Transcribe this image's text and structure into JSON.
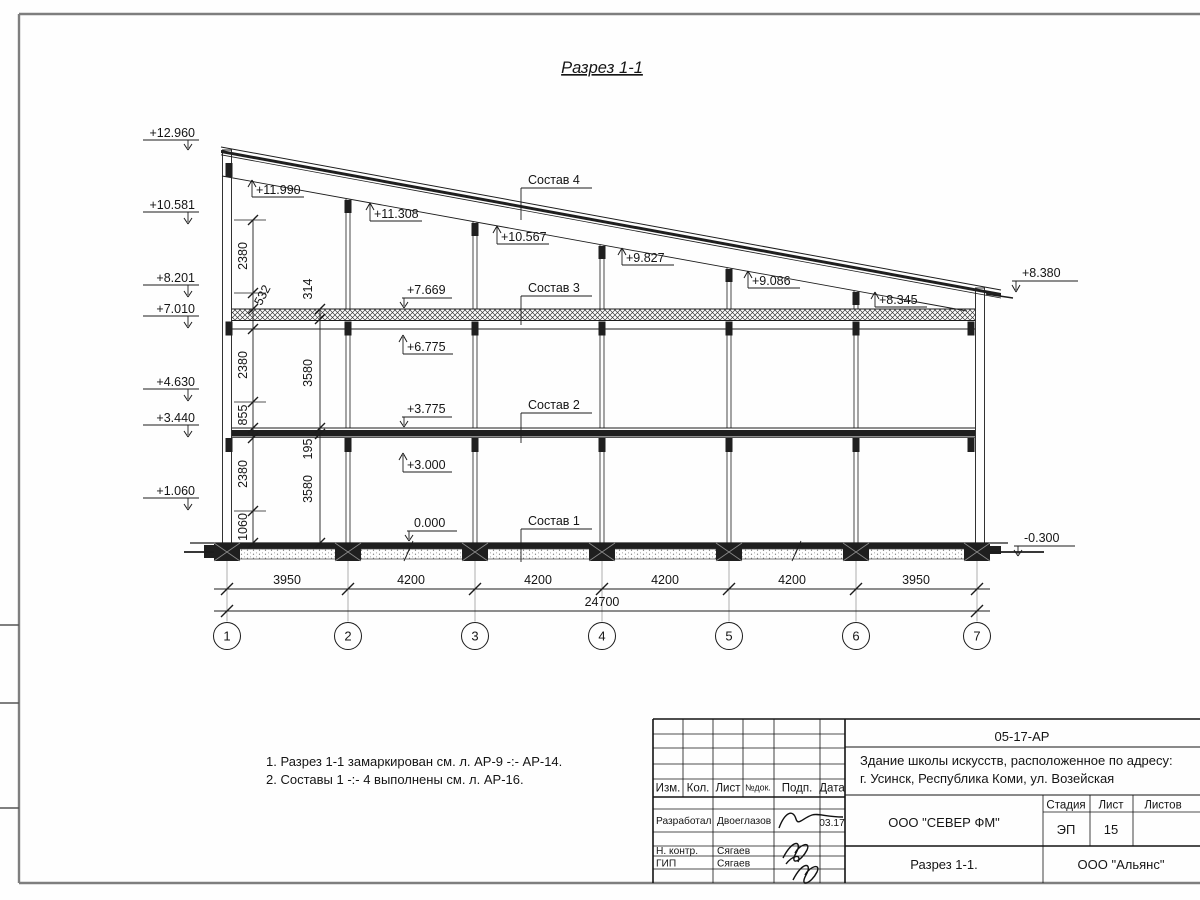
{
  "drawing_title": "Разрез 1-1",
  "section": {
    "left_marks": [
      "+12.960",
      "+10.581",
      "+8.201",
      "+7.010",
      "+4.630",
      "+3.440",
      "+1.060"
    ],
    "roof_marks": [
      "+11.990",
      "+11.308",
      "+10.567",
      "+9.827",
      "+9.086",
      "+8.345"
    ],
    "ceiling_top_mark": "+7.669",
    "ceiling_bottom_mark": "+6.775",
    "floor_top_mark": "+3.775",
    "floor_bottom_mark": "+3.000",
    "ground_mark": "0.000",
    "right_roof_mark": "+8.380",
    "right_ground_mark": "-0.300",
    "layers": [
      "Состав 4",
      "Состав 3",
      "Состав 2",
      "Состав 1"
    ],
    "vdims_a": [
      "2380",
      "532",
      "2380",
      "855",
      "2380",
      "1060"
    ],
    "vdims_b": [
      "314",
      "3580",
      "195",
      "3580"
    ],
    "hdims": [
      "3950",
      "4200",
      "4200",
      "4200",
      "4200",
      "3950"
    ],
    "total": "24700",
    "axes": [
      "1",
      "2",
      "3",
      "4",
      "5",
      "6",
      "7"
    ]
  },
  "notes": [
    "1. Разрез 1-1 замаркирован см. л. АР-9 -:- АР-14.",
    "2. Составы 1 -:- 4 выполнены см. л. АР-16."
  ],
  "stamp": {
    "doc_no": "05-17-АР",
    "object1": "Здание школы искусств, расположенное по адресу:",
    "object2": "г. Усинск, Республика Коми, ул. Возейская",
    "col_izm": "Изм.",
    "col_kol": "Кол.",
    "col_list": "Лист",
    "col_doc": "№док.",
    "col_podp": "Подп.",
    "col_data": "Дата",
    "role1": "Разработал",
    "name1": "Двоеглазов",
    "date1": "03.17",
    "role2": "Н. контр.",
    "name2": "Сягаев",
    "role3": "ГИП",
    "name3": "Сягаев",
    "company": "ООО \"СЕВЕР ФМ\"",
    "stage_h": "Стадия",
    "list_h": "Лист",
    "listov_h": "Листов",
    "stage": "ЭП",
    "list_no": "15",
    "sheet_name": "Разрез 1-1.",
    "org": "ООО \"Альянс\""
  }
}
